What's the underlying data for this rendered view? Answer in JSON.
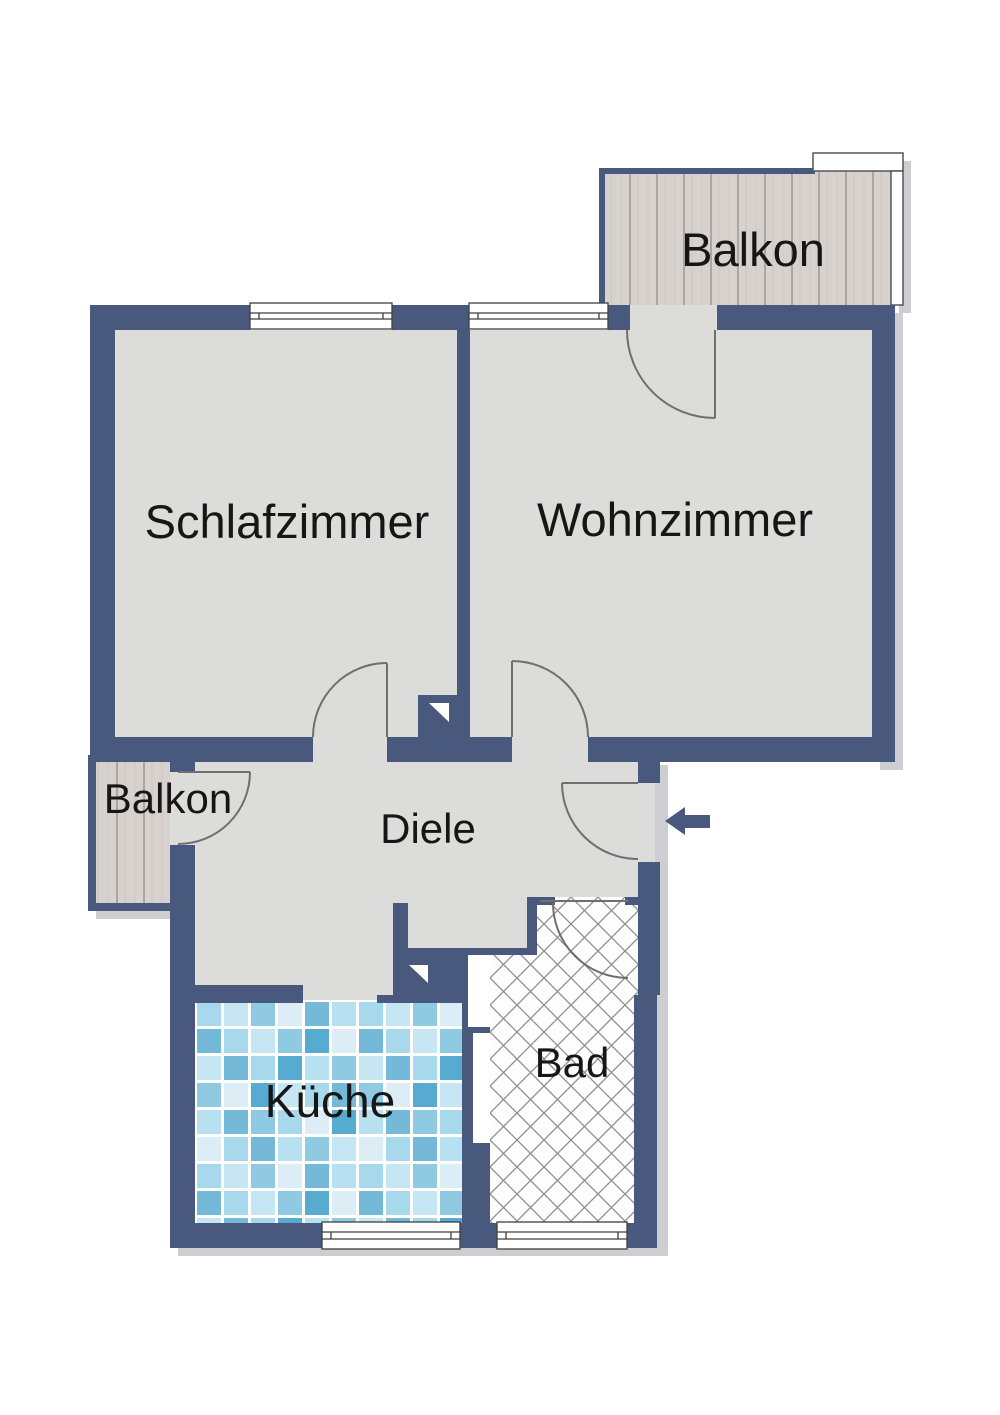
{
  "title": "Grundriss Wohnung",
  "labels": {
    "balkon_top": "Balkon",
    "schlafzimmer": "Schlafzimmer",
    "wohnzimmer": "Wohnzimmer",
    "balkon_left": "Balkon",
    "diele": "Diele",
    "kueche": "Küche",
    "bad": "Bad"
  },
  "colors": {
    "wall": "#49597d",
    "floor": "#dcdcdb",
    "wood_base": "#d7d2ce",
    "wood_line": "#a9a09b",
    "tile_blues": [
      "#a8d8ec",
      "#8fcae2",
      "#c6e6f3",
      "#74bad8",
      "#dcedf6",
      "#b7e0f0",
      "#58abd0"
    ],
    "grout": "#ffffff",
    "hatch_line": "#8e8e8e",
    "hatch_bg": "#fdfdfd",
    "window_fill": "#ffffff",
    "window_frame": "#3f3f3f",
    "door_arc": "#6f6f6f",
    "text": "#161616",
    "shadow": "#cdced1",
    "niche_fill": "#ffffff",
    "marker_triangle": "#ffffff"
  },
  "icons": {
    "entry_arrow": "arrow-left-icon",
    "chimney_marker_upper": "triangle-marker-icon",
    "chimney_marker_lower": "triangle-marker-icon"
  }
}
